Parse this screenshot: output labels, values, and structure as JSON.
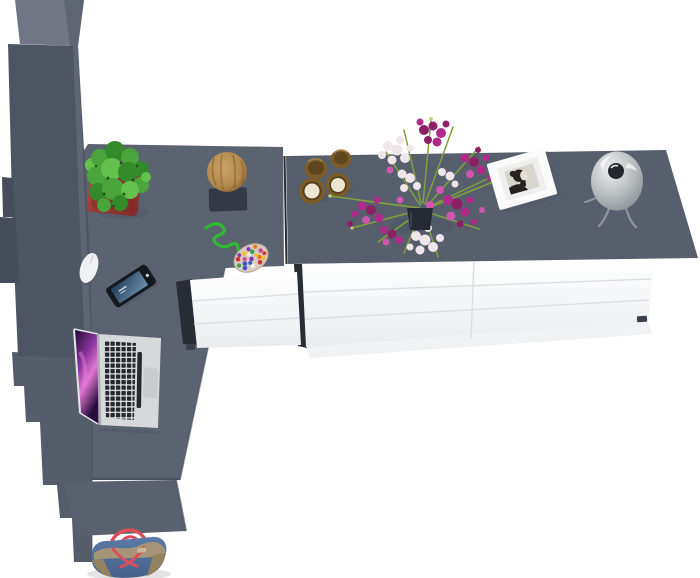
{
  "image": {
    "type": "3d-product-render",
    "subject": "Top-down view of an L-shaped desk set: tall grey cabinet, grey desk top with laptop, phone and mouse, long sideboard with white drawers holding hourglasses, orchid bouquet, photo frame and dome lamp, chair and tote bag below",
    "text_content": "none"
  },
  "furniture": [
    {
      "name": "tall-cabinet",
      "finish": "dark grey"
    },
    {
      "name": "desk-top",
      "finish": "grey"
    },
    {
      "name": "sideboard",
      "finish": "grey top, white drawer fronts"
    },
    {
      "name": "corner-drawer-unit",
      "finish": "white drawer fronts"
    },
    {
      "name": "chair-seat",
      "finish": "grey"
    }
  ],
  "decor_items": [
    "cactus-in-red-pot",
    "wooden-log-stool-on-dark-mat",
    "green-cord-with-colorful-bead-mat",
    "smartphone",
    "computer-mouse",
    "open-laptop-purple-wallpaper",
    "two-brass-hourglasses",
    "magenta-and-white-orchid-bouquet",
    "white-photo-frame-bw-portrait",
    "grey-dome-table-lamp",
    "denim-tote-bag-red-handles"
  ],
  "colors": {
    "floor": "#ffffff",
    "desk-top": "#5b6270",
    "sideboard-top": "#575f6d",
    "column-lower": "#555c6a",
    "chair": "#59616f",
    "wardrobe-top": "#707683",
    "wardrobe-side": "#4d5462",
    "wardrobe-facet": "#5e6573",
    "wardrobe-door": "#454c5a",
    "dark-sliver": "#272c35",
    "drawer-seam": "#dcdfe2",
    "drawer-grad": "#e9ebee",
    "edge-shade": "#4a515f",
    "foot-dark": "#3c424c",
    "floor-shadow": "#f1f2f3",
    "shadow": "#47505f",
    "pot-red-light": "#c0524a",
    "pot-red": "#a23a35",
    "pot-red-dark": "#7e2b28",
    "cactus-1": "#4aa53c",
    "cactus-2": "#348a2b",
    "cactus-3": "#63c24e",
    "cactus-dark": "#1e5219",
    "log-light": "#c9a263",
    "log-mid": "#b58a4f",
    "log-dark": "#7a5426",
    "log-mat": "#333945",
    "cord-green": "#2db92d",
    "bead-base": "#d8ccc2",
    "bead-rim": "#b5a596",
    "bead-red": "#cf3434",
    "bead-blue": "#3a55c4",
    "bead-yellow": "#f0c030",
    "bead-purple": "#8a35b0",
    "bead-green": "#3aa040",
    "bead-orange": "#e87820",
    "bead-white": "#eeeeee",
    "bead-pink": "#d04898",
    "phone-body": "#15181d",
    "phone-screen-1": "#223c58",
    "phone-screen-2": "#6b91ad",
    "mouse-white": "#eef0f1",
    "laptop-silver": "#d6d8da",
    "laptop-edge": "#a9acb0",
    "bezel": "#e3e5e7",
    "key-dark": "#27292c",
    "trackpad": "#c9cbce",
    "screen-dark": "#170826",
    "screen-mid": "#8c35a0",
    "screen-hot": "#e277d2",
    "screen-deep": "#2a0d3c",
    "brass": "#7c5d2a",
    "brass-dark": "#57411c",
    "sand": "#ece5d2",
    "stem": "#7fa03c",
    "bud": "#b9cf6a",
    "fl-magenta": "#b02a8a",
    "fl-deep": "#8e1f66",
    "fl-light": "#cf55ae",
    "fl-white": "#efe5eb",
    "vase": "#262a34",
    "frame-white": "#fbfbfb",
    "frame-mat": "#efefed",
    "photo-bg": "#d8d4ce",
    "photo-dark": "#262220",
    "photo-skin": "#e7dfd3",
    "dome-light": "#eef0f1",
    "dome-mid": "#b9bec1",
    "dome-edge": "#878d91",
    "dome-hl": "#f6f8f8",
    "chrome-dark": "#23262a",
    "leg-chrome": "#8f959a",
    "bag-denim": "#46618b",
    "bag-denim-light": "#5a7aa6",
    "bag-tan": "#a69478",
    "bag-tan-dark": "#93815f",
    "bag-red": "#e04b59"
  }
}
